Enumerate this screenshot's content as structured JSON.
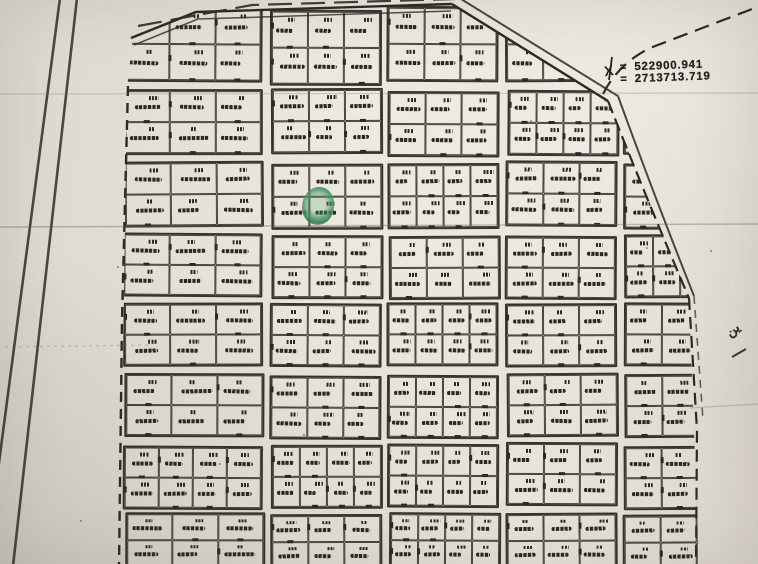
{
  "document": {
    "kind": "scanned cadastral subdivision plat map, photographed on paper"
  },
  "annotations": {
    "station_label": "X",
    "coord_line1": {
      "prefix": "=",
      "value": "522900.941"
    },
    "coord_line2": {
      "prefix": "=",
      "value": "2713713.719"
    },
    "arabic_fragment": "ين"
  },
  "marker": {
    "description": "hand-drawn green circle highlighting one parcel",
    "x": 302,
    "y": 187,
    "w": 32,
    "h": 38,
    "color": "#3f9469"
  },
  "map": {
    "colors": {
      "ink": "#2b2924",
      "paper": "#e7e3d9",
      "faint_fold": "#6e685e",
      "green": "#3f9469"
    },
    "boundary_polygon": [
      [
        133,
        36
      ],
      [
        196,
        12
      ],
      [
        452,
        4
      ],
      [
        608,
        102
      ],
      [
        689,
        298
      ],
      [
        699,
        564
      ],
      [
        120,
        564
      ],
      [
        127,
        88
      ]
    ],
    "grid": {
      "columns": [
        {
          "x": 124,
          "w": 140
        },
        {
          "x": 270,
          "w": 112
        },
        {
          "x": 388,
          "w": 112
        },
        {
          "x": 506,
          "w": 112
        },
        {
          "x": 624,
          "w": 112
        }
      ],
      "rows": [
        {
          "y": 8,
          "h": 76
        },
        {
          "y": 90,
          "h": 66
        },
        {
          "y": 162,
          "h": 66
        },
        {
          "y": 234,
          "h": 64
        },
        {
          "y": 304,
          "h": 64
        },
        {
          "y": 374,
          "h": 64
        },
        {
          "y": 444,
          "h": 64
        },
        {
          "y": 514,
          "h": 56
        }
      ],
      "parcel_rows_per_block": 2,
      "parcel_cols_per_block": "3 or 4",
      "note": "each parcel bears an illegible handwritten plot number and Arabic inscription"
    }
  }
}
